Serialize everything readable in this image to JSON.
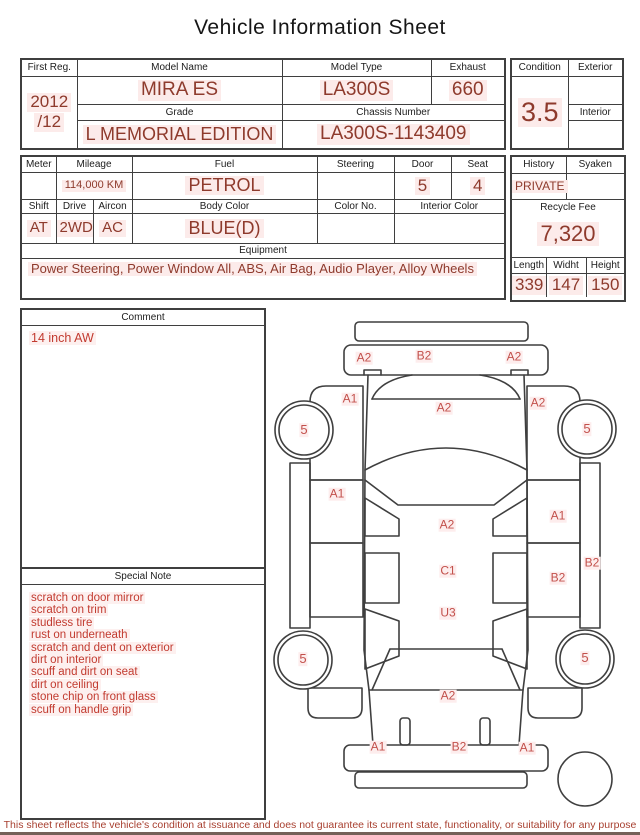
{
  "title": "Vehicle Information Sheet",
  "vehicle_table": {
    "first_reg": {
      "label": "First Reg.",
      "value_line1": "2012",
      "value_line2": "/12"
    },
    "model_name": {
      "label": "Model Name",
      "value": "MIRA ES"
    },
    "model_type": {
      "label": "Model Type",
      "value": "LA300S"
    },
    "exhaust": {
      "label": "Exhaust",
      "value": "660"
    },
    "grade": {
      "label": "Grade",
      "value": "L MEMORIAL EDITION"
    },
    "chassis_number": {
      "label": "Chassis Number",
      "value": "LA300S-1143409"
    }
  },
  "condition_block": {
    "condition": {
      "label": "Condition",
      "value": "3.5"
    },
    "exterior": {
      "label": "Exterior",
      "value": ""
    },
    "interior": {
      "label": "Interior",
      "value": ""
    }
  },
  "spec_table": {
    "meter": {
      "label": "Meter",
      "value": ""
    },
    "mileage": {
      "label": "Mileage",
      "value": "114,000 KM"
    },
    "fuel": {
      "label": "Fuel",
      "value": "PETROL"
    },
    "steering": {
      "label": "Steering",
      "value": ""
    },
    "door": {
      "label": "Door",
      "value": "5"
    },
    "seat": {
      "label": "Seat",
      "value": "4"
    },
    "shift": {
      "label": "Shift",
      "value": "AT"
    },
    "drive": {
      "label": "Drive",
      "value": "2WD"
    },
    "aircon": {
      "label": "Aircon",
      "value": "AC"
    },
    "body_color": {
      "label": "Body Color",
      "value": "BLUE(D)"
    },
    "color_no": {
      "label": "Color No.",
      "value": ""
    },
    "interior_color": {
      "label": "Interior Color",
      "value": ""
    },
    "equipment": {
      "label": "Equipment",
      "value": "Power Steering, Power Window All, ABS, Air Bag, Audio Player, Alloy Wheels"
    }
  },
  "history_block": {
    "history": {
      "label": "History",
      "value": "PRIVATE"
    },
    "syaken": {
      "label": "Syaken",
      "value": ""
    },
    "recycle_fee": {
      "label": "Recycle Fee",
      "value": "7,320"
    },
    "length": {
      "label": "Length",
      "value": "339"
    },
    "width": {
      "label": "Widht",
      "value": "147"
    },
    "height": {
      "label": "Height",
      "value": "150"
    }
  },
  "comment": {
    "label": "Comment",
    "text": "14 inch AW"
  },
  "special_note": {
    "label": "Special Note",
    "items": [
      "scratch on door mirror",
      "scratch on trim",
      "studless tire",
      "rust on underneath",
      "scratch and dent on exterior",
      "dirt on interior",
      "scuff and dirt on seat",
      "dirt on ceiling",
      "stone chip on front glass",
      "scuff on handle grip"
    ]
  },
  "diagram": {
    "markers": {
      "front_bumper_left": "A2",
      "front_bumper_center": "B2",
      "front_bumper_right": "A2",
      "left_front_fender": "A1",
      "hood": "A2",
      "right_front_fender": "A2",
      "wheel_front_left": "5",
      "wheel_front_right": "5",
      "left_front_door": "A1",
      "roof_front": "A2",
      "right_front_door": "A1",
      "roof_center": "C1",
      "right_rear_door": "B2",
      "right_sill": "B2",
      "roof_rear": "U3",
      "wheel_rear_left": "5",
      "wheel_rear_right": "5",
      "rear_hatch": "A2",
      "rear_bumper_left": "A1",
      "rear_bumper_center": "B2",
      "rear_bumper_right": "A1"
    }
  },
  "footer": "This sheet reflects the vehicle's condition at issuance and does not guarantee its current state, functionality, or suitability for any purpose",
  "colors": {
    "value_text": "#8e3a2c",
    "note_text": "#c23b30",
    "marker_text": "#c2504b",
    "border": "#3f3f3f",
    "highlight": "#fcebea"
  }
}
